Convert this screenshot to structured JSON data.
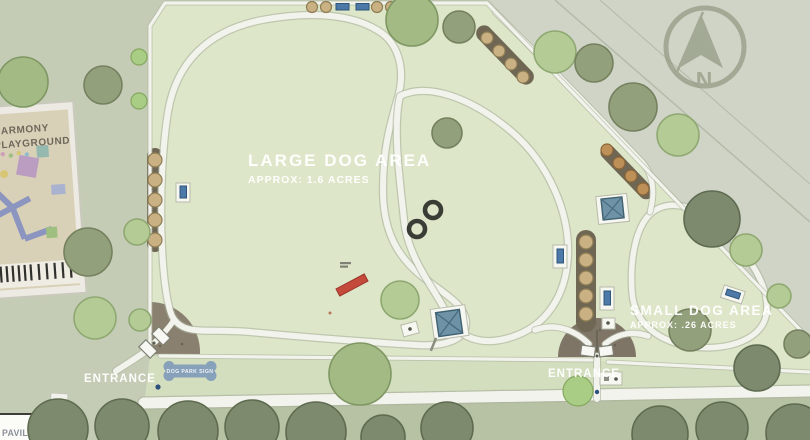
{
  "map": {
    "large_dog_area": {
      "label": "LARGE DOG AREA",
      "acres": "APPROX: 1.6 ACRES"
    },
    "small_dog_area": {
      "label": "SMALL DOG AREA",
      "acres": "APPROX: .26 ACRES"
    },
    "playground": {
      "line1": "HARMONY",
      "line2": "PLAYGROUND"
    },
    "pavilion_label": "PAVILION",
    "entrances": {
      "west": "ENTRANCE",
      "south": "ENTRANCE"
    },
    "dog_park_sign_label": "DOG PARK SIGN",
    "compass": {
      "letter": "N"
    },
    "colors": {
      "parcel_green": "#dde6c8",
      "outside_green": "#c5ccb6",
      "outside_northeast": "#cfd4c6",
      "path_white": "#f2f3ec",
      "bench_blue": "#4c79a8",
      "shade_structure_blue": "#6e92a6",
      "sign_blue": "#87a1ba",
      "agility_red": "#c44a3c",
      "planting_bed_brown": "#6f6754",
      "gravel_pad": "#8a8070",
      "tree_dark": "#7d8a6d",
      "tree_olive": "#93a07c",
      "tree_light": "#b5cb95",
      "compass_gray": "#8f9780"
    }
  }
}
